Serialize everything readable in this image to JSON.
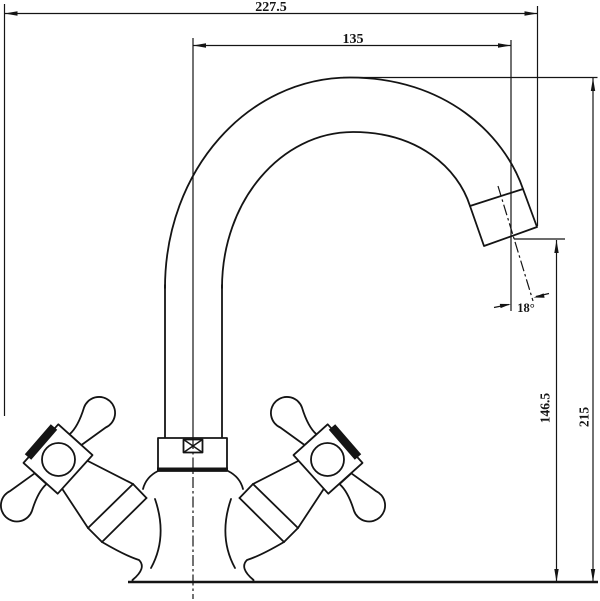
{
  "drawing": {
    "kind": "faucet-dimension-drawing",
    "dims": {
      "overall_width": "227.5",
      "spout_reach": "135",
      "spout_angle": "18°",
      "outlet_height": "146.5",
      "overall_height": "215"
    },
    "ink_color": "#141414",
    "paper_color": "#ffffff"
  }
}
